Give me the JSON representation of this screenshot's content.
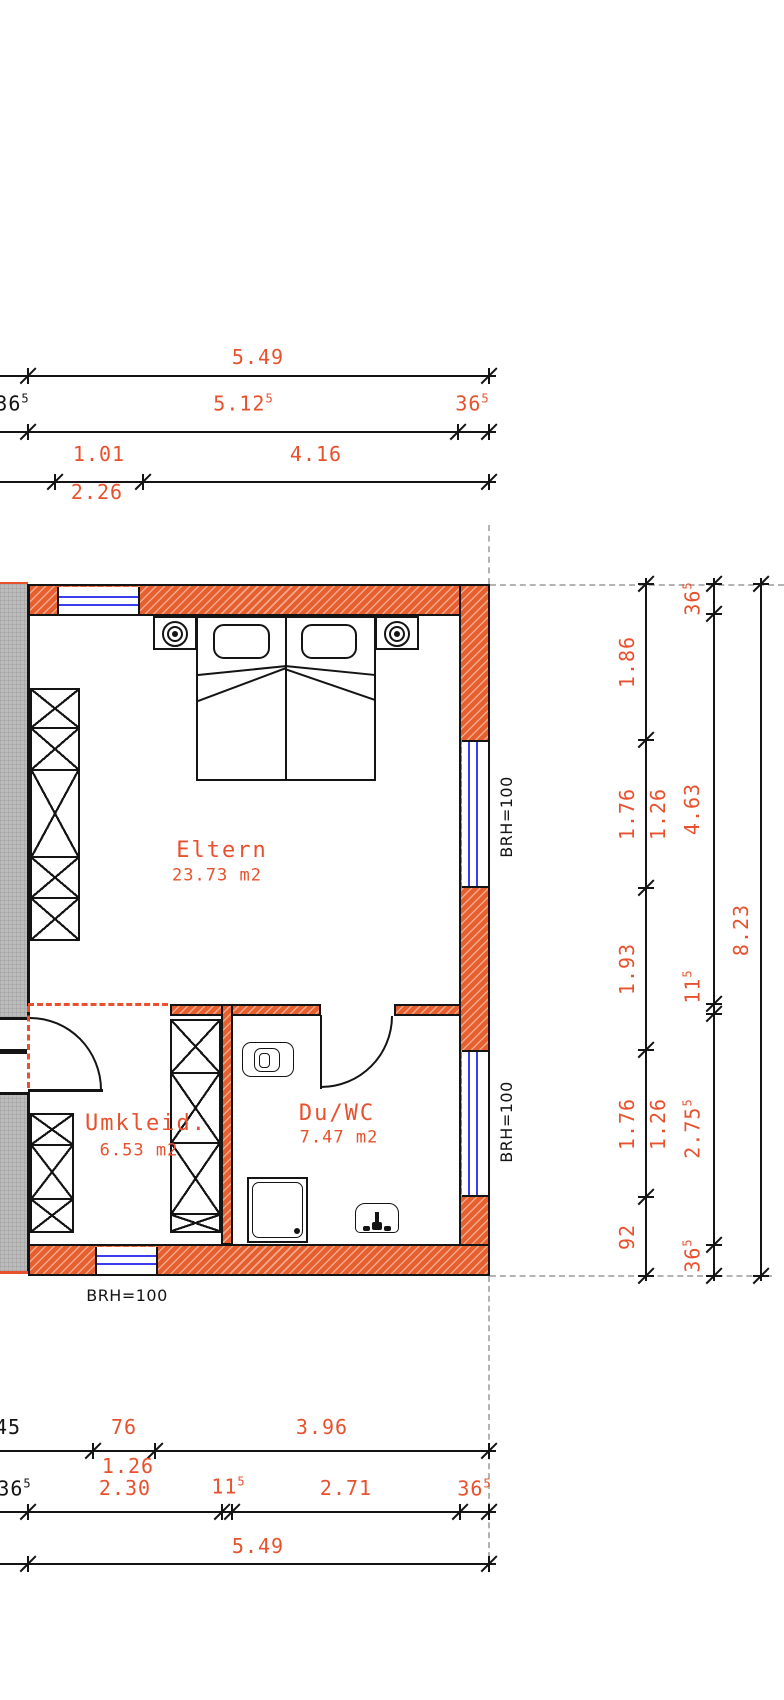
{
  "title": "Grundriss-Ausschnitt Obergeschoss",
  "colors": {
    "accent": "#e8512e",
    "wall_fill": "#e6602f",
    "window_blue": "#3b3bf0",
    "guide": "#b3b3b3",
    "gray_fill": "#bcbcbc",
    "line": "#141414"
  },
  "rooms": [
    {
      "name": "Eltern",
      "area": "23.73 m2",
      "cx": 222,
      "cy": 851,
      "ax": 217,
      "ay": 876
    },
    {
      "name": "Umkleid.",
      "area": "6.53 m2",
      "cx": 146,
      "cy": 1124,
      "ax": 139,
      "ay": 1151
    },
    {
      "name": "Du/WC",
      "area": "7.47 m2",
      "cx": 337,
      "cy": 1114,
      "ax": 339,
      "ay": 1138
    }
  ],
  "brh_labels": [
    {
      "text": "BRH=100",
      "x": 507,
      "y": 817,
      "rot": true
    },
    {
      "text": "BRH=100",
      "x": 507,
      "y": 1122,
      "rot": true
    },
    {
      "text": "BRH=100",
      "x": 127,
      "y": 1296,
      "rot": false
    }
  ],
  "dim_lines": {
    "h": [
      {
        "y": 375,
        "x1": 0,
        "x2": 496,
        "ticks": [
          28,
          489
        ]
      },
      {
        "y": 431,
        "x1": 0,
        "x2": 496,
        "ticks": [
          28,
          458,
          489
        ]
      },
      {
        "y": 481,
        "x1": 0,
        "x2": 496,
        "ticks": [
          55,
          143,
          489
        ]
      },
      {
        "y": 1450,
        "x1": 0,
        "x2": 496,
        "ticks": [
          93,
          155,
          489
        ]
      },
      {
        "y": 1511,
        "x1": 0,
        "x2": 496,
        "ticks": [
          28,
          222,
          232,
          460,
          489
        ]
      },
      {
        "y": 1563,
        "x1": 0,
        "x2": 496,
        "ticks": [
          28,
          489
        ]
      }
    ],
    "v": [
      {
        "x": 645,
        "y1": 578,
        "y2": 1281,
        "ticks": [
          584,
          740,
          888,
          1050,
          1197,
          1276
        ]
      },
      {
        "x": 713,
        "y1": 578,
        "y2": 1281,
        "ticks": [
          584,
          614,
          1004,
          1014,
          1245,
          1276
        ]
      },
      {
        "x": 760,
        "y1": 578,
        "y2": 1281,
        "ticks": [
          584,
          1276
        ]
      }
    ]
  },
  "dim_labels": [
    {
      "v": "5.49",
      "x": 258,
      "y": 357
    },
    {
      "v": "36",
      "s": "5",
      "x": 12,
      "y": 403,
      "black": true
    },
    {
      "v": "5.12",
      "s": "5",
      "x": 243,
      "y": 403
    },
    {
      "v": "36",
      "s": "5",
      "x": 472,
      "y": 403
    },
    {
      "v": "1.01",
      "x": 99,
      "y": 454
    },
    {
      "v": "4.16",
      "x": 316,
      "y": 454
    },
    {
      "v": "2.26",
      "x": 97,
      "y": 492
    },
    {
      "v": "45",
      "x": 8,
      "y": 1427,
      "black": true
    },
    {
      "v": "76",
      "x": 124,
      "y": 1427
    },
    {
      "v": "3.96",
      "x": 322,
      "y": 1427
    },
    {
      "v": "1.26",
      "x": 128,
      "y": 1466
    },
    {
      "v": "36",
      "s": "5",
      "x": 14,
      "y": 1488,
      "black": true
    },
    {
      "v": "2.30",
      "x": 125,
      "y": 1488
    },
    {
      "v": "11",
      "s": "5",
      "x": 228,
      "y": 1486
    },
    {
      "v": "2.71",
      "x": 346,
      "y": 1488
    },
    {
      "v": "36",
      "s": "5",
      "x": 474,
      "y": 1488
    },
    {
      "v": "5.49",
      "x": 258,
      "y": 1546
    },
    {
      "v": "1.86",
      "x": 627,
      "y": 662,
      "rot": true
    },
    {
      "v": "1.76",
      "x": 627,
      "y": 814,
      "rot": true
    },
    {
      "v": "1.26",
      "x": 658,
      "y": 814,
      "rot": true
    },
    {
      "v": "1.93",
      "x": 627,
      "y": 969,
      "rot": true
    },
    {
      "v": "1.76",
      "x": 627,
      "y": 1124,
      "rot": true
    },
    {
      "v": "1.26",
      "x": 658,
      "y": 1124,
      "rot": true
    },
    {
      "v": "92",
      "x": 627,
      "y": 1237,
      "rot": true
    },
    {
      "v": "36",
      "s": "5",
      "x": 692,
      "y": 599,
      "rot": true
    },
    {
      "v": "4.63",
      "x": 692,
      "y": 809,
      "rot": true
    },
    {
      "v": "11",
      "s": "5",
      "x": 692,
      "y": 987,
      "rot": true
    },
    {
      "v": "2.75",
      "s": "5",
      "x": 692,
      "y": 1129,
      "rot": true
    },
    {
      "v": "36",
      "s": "5",
      "x": 692,
      "y": 1256,
      "rot": true
    },
    {
      "v": "8.23",
      "x": 741,
      "y": 930,
      "rot": true
    }
  ]
}
